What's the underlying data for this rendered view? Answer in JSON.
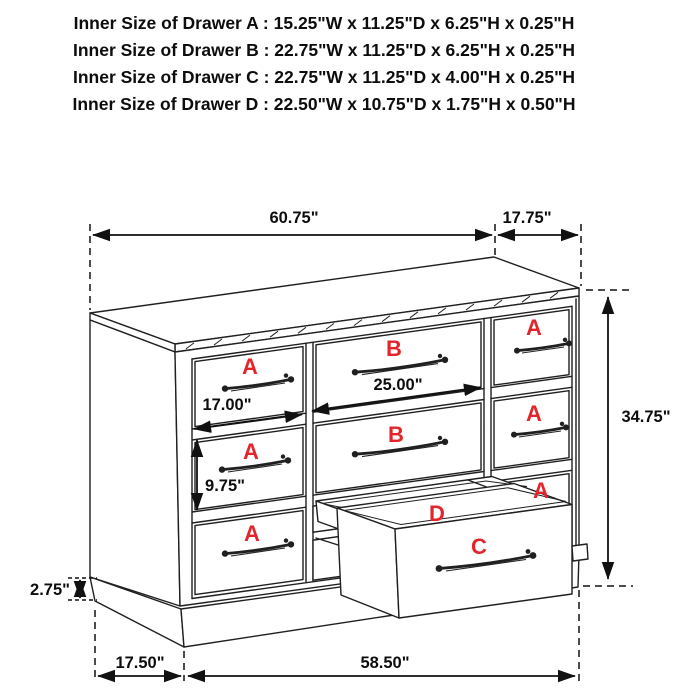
{
  "header": {
    "lines": [
      "Inner Size of Drawer A : 15.25\"W x 11.25\"D x 6.25\"H x 0.25\"H",
      "Inner Size of Drawer B : 22.75\"W x 11.25\"D x 6.25\"H x 0.25\"H",
      "Inner Size of Drawer C : 22.75\"W x 11.25\"D x 4.00\"H x 0.25\"H",
      "Inner Size of Drawer  D : 22.50\"W x 10.75\"D x 1.75\"H x 0.50\"H"
    ]
  },
  "diagram": {
    "drawer_letters": {
      "a": "A",
      "b": "B",
      "c": "C",
      "d": "D"
    },
    "dims": {
      "overall_width": "60.75\"",
      "overall_depth": "17.75\"",
      "overall_height": "34.75\"",
      "drawer_b_front_width": "25.00\"",
      "drawer_a_front_width": "17.00\"",
      "drawer_a_front_height": "9.75\"",
      "base_height": "2.75\"",
      "base_side_depth": "17.50\"",
      "base_front_width": "58.50\""
    },
    "colors": {
      "letter_red": "#e3252b",
      "line_black": "#202020"
    }
  }
}
